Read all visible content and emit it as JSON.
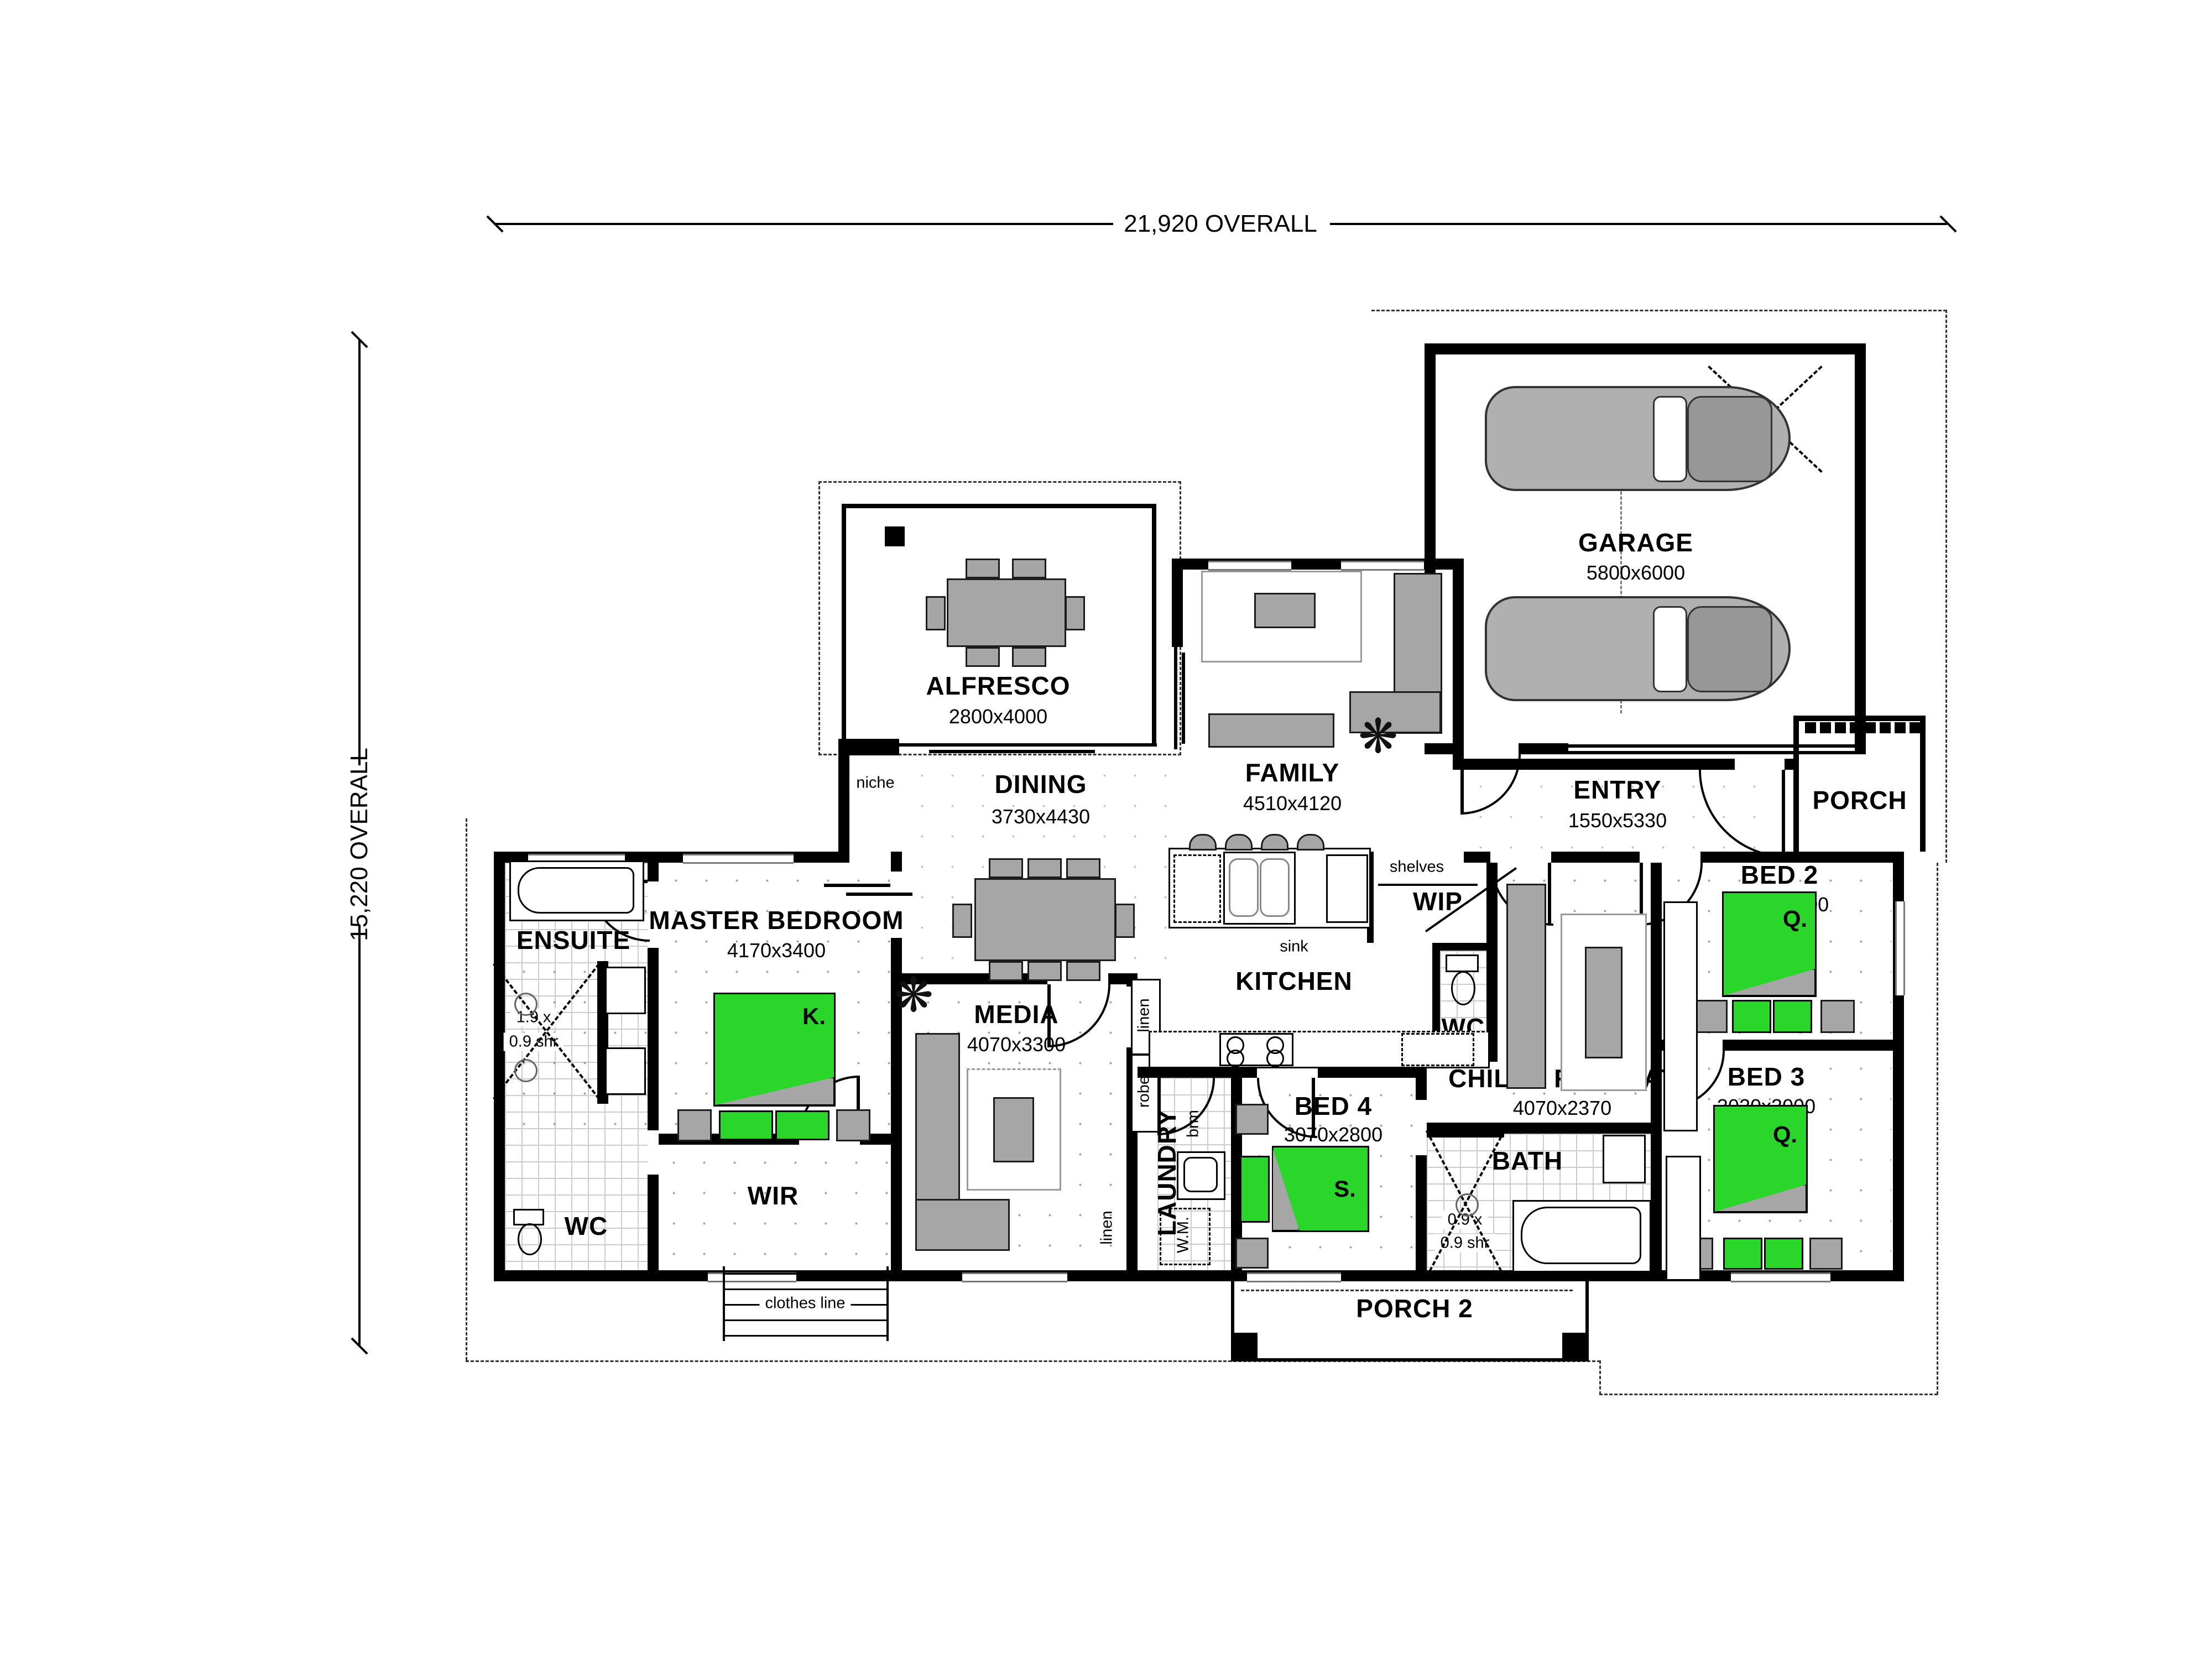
{
  "overall_dims": {
    "top": "21,920 OVERALL",
    "left": "15,220 OVERALL"
  },
  "rooms": {
    "alfresco": {
      "name": "ALFRESCO",
      "dims": "2800x4000"
    },
    "dining": {
      "name": "DINING",
      "dims": "3730x4430"
    },
    "family": {
      "name": "FAMILY",
      "dims": "4510x4120"
    },
    "garage": {
      "name": "GARAGE",
      "dims": "5800x6000"
    },
    "entry": {
      "name": "ENTRY",
      "dims": "1550x5330"
    },
    "porch": {
      "name": "PORCH"
    },
    "porch2": {
      "name": "PORCH 2"
    },
    "master": {
      "name": "MASTER BEDROOM",
      "dims": "4170x3400"
    },
    "ensuite": {
      "name": "ENSUITE"
    },
    "wir": {
      "name": "WIR"
    },
    "media": {
      "name": "MEDIA",
      "dims": "4070x3300"
    },
    "kitchen": {
      "name": "KITCHEN"
    },
    "wip": {
      "name": "WIP"
    },
    "laundry": {
      "name": "LAUNDRY"
    },
    "childs_retreat": {
      "name": "CHILDS RETREAT",
      "dims": "4070x2370"
    },
    "bed2": {
      "name": "BED 2",
      "dims": "2990x3000"
    },
    "bed3": {
      "name": "BED 3",
      "dims": "3020x3000"
    },
    "bed4": {
      "name": "BED 4",
      "dims": "3070x2800"
    },
    "bath": {
      "name": "BATH"
    },
    "wc": {
      "name": "WC"
    }
  },
  "fixtures": {
    "niche": "niche",
    "shelves": "shelves",
    "sink": "sink",
    "mw": "mw",
    "dw": "dw",
    "ohc": "ohc",
    "ref": "ref",
    "robe": "robe",
    "linen": "linen",
    "brm": "brm",
    "tub": "tub",
    "wm": "W.M.",
    "clothes_line": "clothes line"
  },
  "shower_notes": {
    "ensuite_line1": "1.9 x",
    "ensuite_line2": "0.9 shr",
    "bath_line1": "0.9 x",
    "bath_line2": "0.9 shr"
  },
  "bed_tags": {
    "king": "K.",
    "queen": "Q.",
    "single": "S."
  },
  "icons": {
    "plant": "❋"
  },
  "colors": {
    "bed_green": "#2BD62B",
    "furniture_grey": "#A6A6A6",
    "wall_black": "#000000",
    "tile_grey": "#CCCCCC"
  }
}
